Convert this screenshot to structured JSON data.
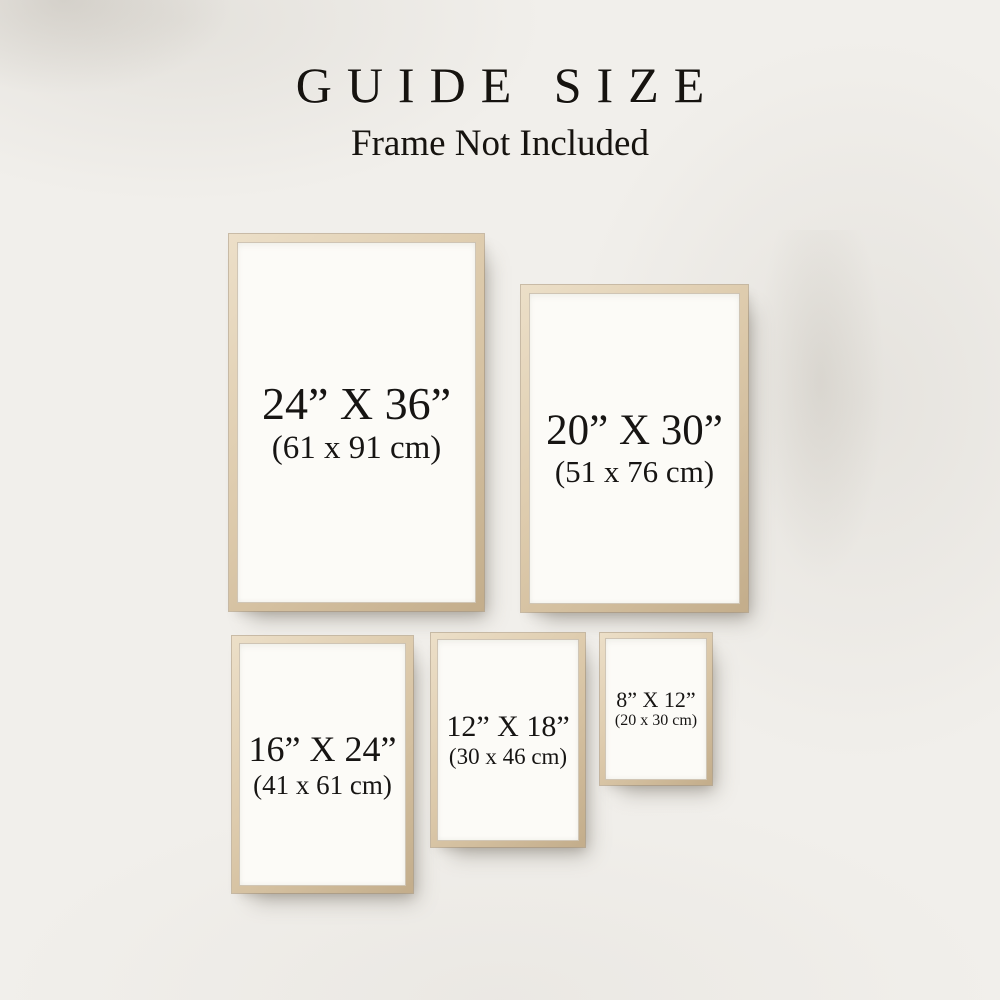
{
  "header": {
    "title": "GUIDE SIZE",
    "subtitle": "Frame Not Included"
  },
  "frames": [
    {
      "name": "24x36",
      "inches": "24” X 36”",
      "cm": "(61 x 91 cm)"
    },
    {
      "name": "20x30",
      "inches": "20” X 30”",
      "cm": "(51 x 76 cm)"
    },
    {
      "name": "16x24",
      "inches": "16” X 24”",
      "cm": "(41 x 61 cm)"
    },
    {
      "name": "12x18",
      "inches": "12” X 18”",
      "cm": "(30 x 46 cm)"
    },
    {
      "name": "8x12",
      "inches": "8” X 12”",
      "cm": "(20 x 30 cm)"
    }
  ],
  "colors": {
    "background": "#f1efeb",
    "paper": "#fcfbf7",
    "wood": "#dcc9aa",
    "wood_light": "#ecdfc8",
    "wood_dark": "#c3ad8b",
    "text": "#171513"
  }
}
